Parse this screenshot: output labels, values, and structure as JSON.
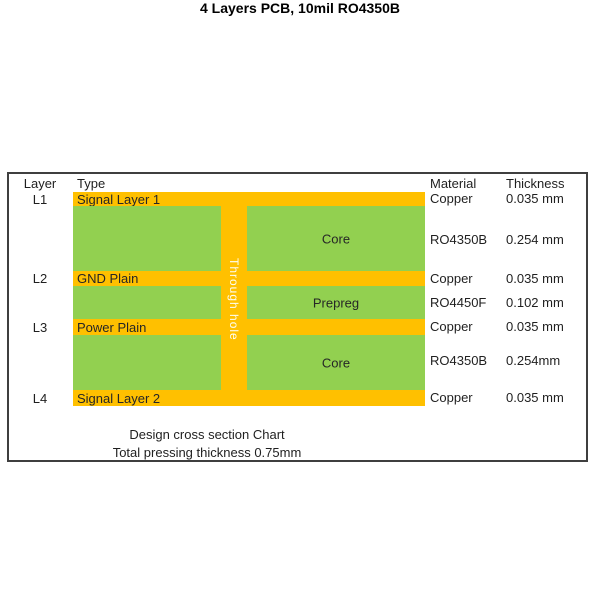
{
  "title": "4 Layers PCB, 10mil RO4350B",
  "colors": {
    "copper": "#ffc000",
    "core": "#92d050",
    "border": "#3f3f3f"
  },
  "header": {
    "layer": "Layer",
    "type": "Type",
    "material": "Material",
    "thickness": "Thickness"
  },
  "rows": [
    {
      "layer": "L1",
      "type": "Signal Layer 1",
      "material": "Copper",
      "thickness": "0.035 mm",
      "kind": "copper"
    },
    {
      "layer": "",
      "type": "Core",
      "material": "RO4350B",
      "thickness": "0.254 mm",
      "kind": "core"
    },
    {
      "layer": "L2",
      "type": "GND Plain",
      "material": "Copper",
      "thickness": "0.035 mm",
      "kind": "copper"
    },
    {
      "layer": "",
      "type": "Prepreg",
      "material": "RO4450F",
      "thickness": "0.102 mm",
      "kind": "prepreg"
    },
    {
      "layer": "L3",
      "type": "Power Plain",
      "material": "Copper",
      "thickness": "0.035 mm",
      "kind": "copper"
    },
    {
      "layer": "",
      "type": "Core",
      "material": "RO4350B",
      "thickness": "0.254mm",
      "kind": "core"
    },
    {
      "layer": "L4",
      "type": "Signal Layer 2",
      "material": "Copper",
      "thickness": "0.035 mm",
      "kind": "copper"
    }
  ],
  "through_hole_label": "Through hole",
  "footer": {
    "line1": "Design cross section Chart",
    "line2": "Total pressing thickness 0.75mm"
  }
}
